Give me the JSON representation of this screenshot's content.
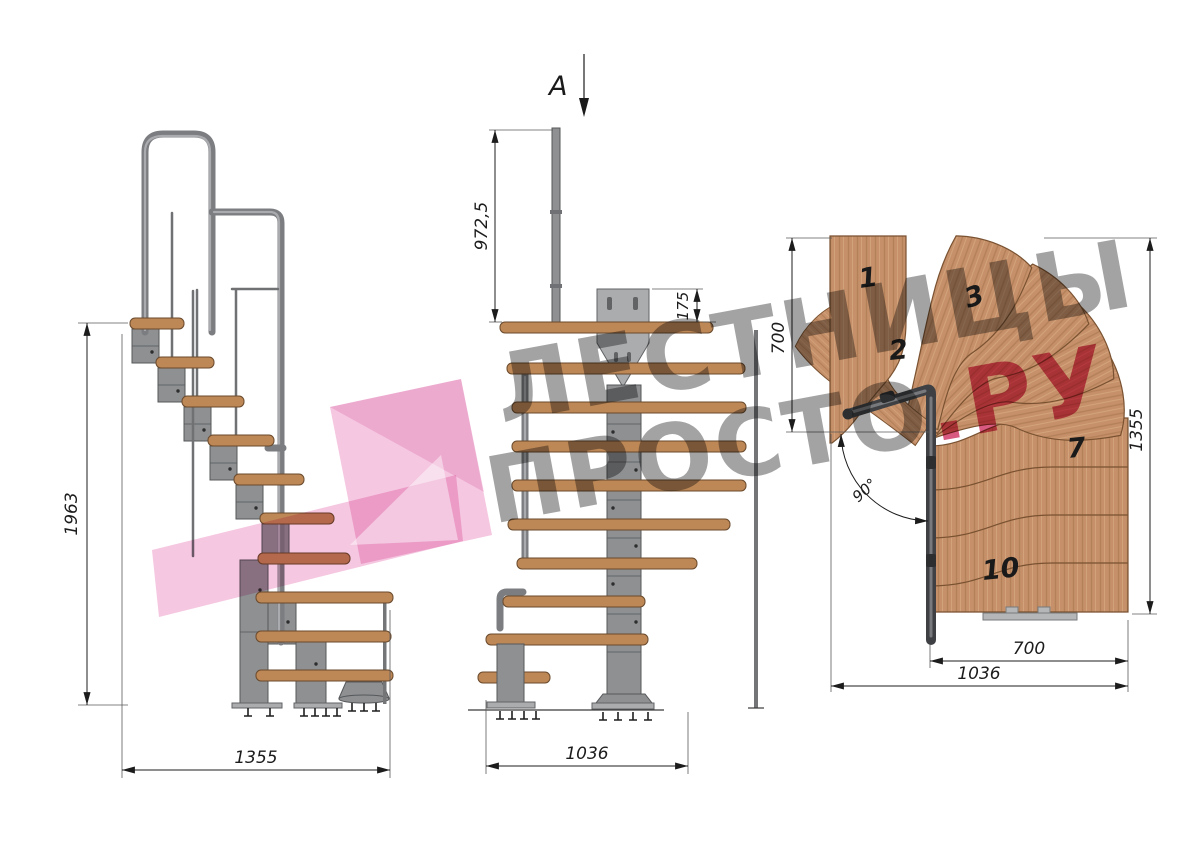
{
  "watermark": {
    "line1": "ЛЕСТНИЦЫ",
    "line2_gray": "ПРОСТО",
    "line2_pink": ".РУ",
    "gray_color": "#808080",
    "pink_color": "#ce2c5e",
    "logo_pink": "#f2b9d9"
  },
  "side_view": {
    "height_dim": "1963",
    "width_dim": "1355"
  },
  "front_view": {
    "section_mark": "A",
    "post_height_dim": "972,5",
    "bracket_height_dim": "175",
    "width_dim": "1036"
  },
  "plan_view": {
    "left_depth_dim": "700",
    "right_height_dim": "1355",
    "turn_angle": "90°",
    "inner_width_dim": "700",
    "outer_width_dim": "1036",
    "tread_labels": [
      "1",
      "2",
      "3",
      "7",
      "10"
    ]
  },
  "colors": {
    "wood_side": "#bd8756",
    "wood_plan": "#c6916a",
    "metal": "#8e9092",
    "dimension": "#1c1c1c"
  }
}
